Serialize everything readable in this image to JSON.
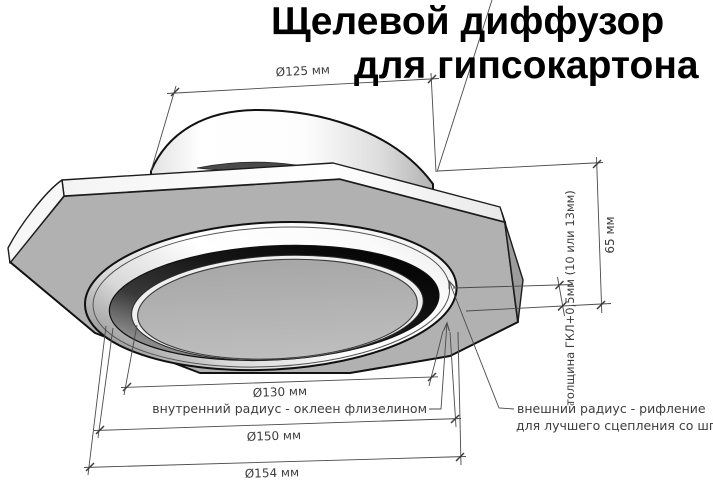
{
  "title": {
    "line1": "Щелевой диффузор",
    "line2": "для гипсокартона"
  },
  "dimensions": {
    "collar_diameter": "Ø125 мм",
    "inner_ring_diameter": "Ø130 мм",
    "outer_ring_diameter": "Ø150 мм",
    "flange_diameter": "Ø154 мм",
    "total_height": "65 мм",
    "panel_thickness": "толщина ГКЛ+0,5мм (10 или 13мм)"
  },
  "annotations": {
    "inner_radius": "внутренний радиус - оклеен флизелином",
    "outer_radius_line1": "внешний радиус - рифление",
    "outer_radius_line2": "для лучшего сцепления со шпаклёвкой"
  },
  "colors": {
    "background": "#ffffff",
    "dimension_line": "#4a4a4a",
    "dimension_text": "#3d3d3d",
    "title_text": "#000000",
    "plate_underside": "#b1b1b1",
    "plate_edge_band": "#fbfbfb",
    "plate_right_face": "#9c9c9c",
    "slot_ring_dark": "#141414",
    "center_disc": "#b5b5b5",
    "collar_dome": "#ffffff"
  }
}
